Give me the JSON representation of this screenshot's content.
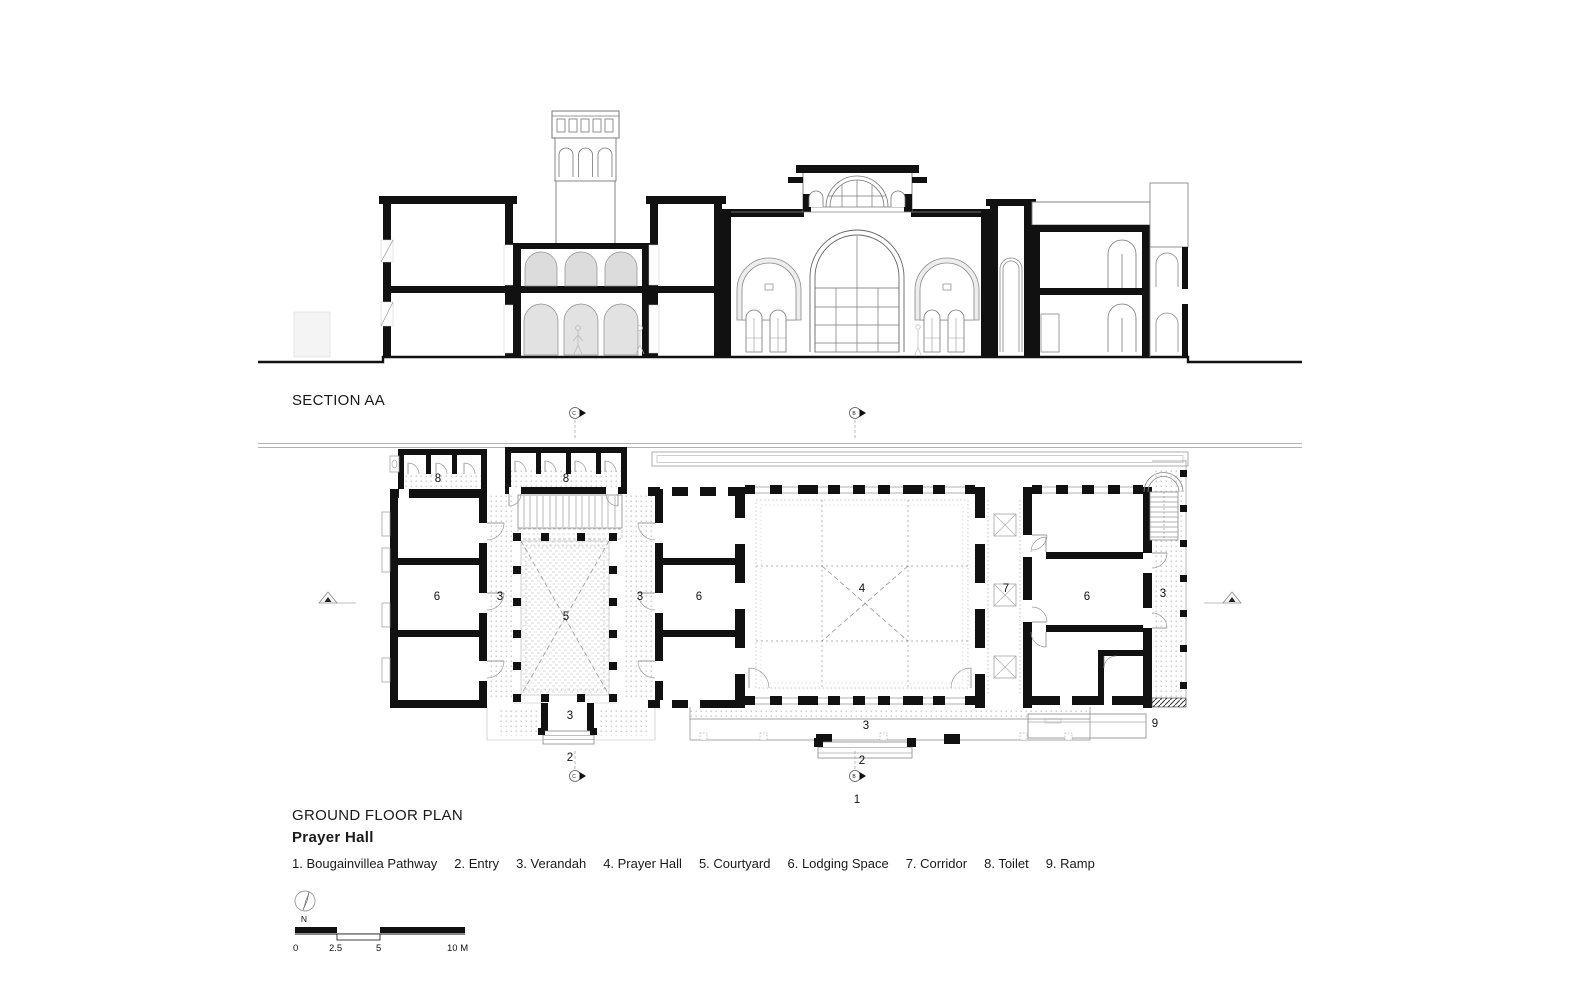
{
  "titles": {
    "section": "SECTION AA",
    "plan": "GROUND FLOOR PLAN",
    "subtitle": "Prayer Hall"
  },
  "legend": {
    "items": [
      {
        "num": "1",
        "name": "Bougainvillea Pathway"
      },
      {
        "num": "2",
        "name": "Entry"
      },
      {
        "num": "3",
        "name": "Verandah"
      },
      {
        "num": "4",
        "name": "Prayer Hall"
      },
      {
        "num": "5",
        "name": "Courtyard"
      },
      {
        "num": "6",
        "name": "Lodging Space"
      },
      {
        "num": "7",
        "name": "Corridor"
      },
      {
        "num": "8",
        "name": "Toilet"
      },
      {
        "num": "9",
        "name": "Ramp"
      }
    ]
  },
  "north": {
    "label": "N"
  },
  "scale_bar": {
    "labels": [
      "0",
      "2.5",
      "5",
      "10 M"
    ]
  },
  "plan": {
    "room_labels": [
      {
        "text": "8",
        "x": 438,
        "y": 482
      },
      {
        "text": "8",
        "x": 566,
        "y": 482
      },
      {
        "text": "6",
        "x": 437,
        "y": 600
      },
      {
        "text": "3",
        "x": 500,
        "y": 600
      },
      {
        "text": "5",
        "x": 566,
        "y": 620
      },
      {
        "text": "3",
        "x": 640,
        "y": 600
      },
      {
        "text": "6",
        "x": 699,
        "y": 600
      },
      {
        "text": "4",
        "x": 862,
        "y": 592
      },
      {
        "text": "7",
        "x": 1006,
        "y": 592
      },
      {
        "text": "6",
        "x": 1087,
        "y": 600
      },
      {
        "text": "3",
        "x": 1163,
        "y": 597
      },
      {
        "text": "3",
        "x": 570,
        "y": 719
      },
      {
        "text": "2",
        "x": 570,
        "y": 761
      },
      {
        "text": "3",
        "x": 866,
        "y": 729
      },
      {
        "text": "2",
        "x": 862,
        "y": 764
      },
      {
        "text": "9",
        "x": 1155,
        "y": 727
      },
      {
        "text": "1",
        "x": 857,
        "y": 803
      }
    ],
    "section_markers": [
      {
        "letter": "C",
        "x": 575,
        "y": 413,
        "tail": "down"
      },
      {
        "letter": "B",
        "x": 855,
        "y": 413,
        "tail": "down"
      },
      {
        "letter": "C",
        "x": 575,
        "y": 776,
        "tail": "up"
      },
      {
        "letter": "B",
        "x": 855,
        "y": 776,
        "tail": "up"
      }
    ],
    "elevation_markers": [
      {
        "letter": "A",
        "x": 328,
        "y": 597,
        "side": "left"
      },
      {
        "letter": "A",
        "x": 1232,
        "y": 597,
        "side": "right"
      }
    ]
  },
  "colors": {
    "wall": "#111111",
    "thin_line": "#777777",
    "dots": "#b9b9b9",
    "arch_fill": "#dcdcdc"
  }
}
